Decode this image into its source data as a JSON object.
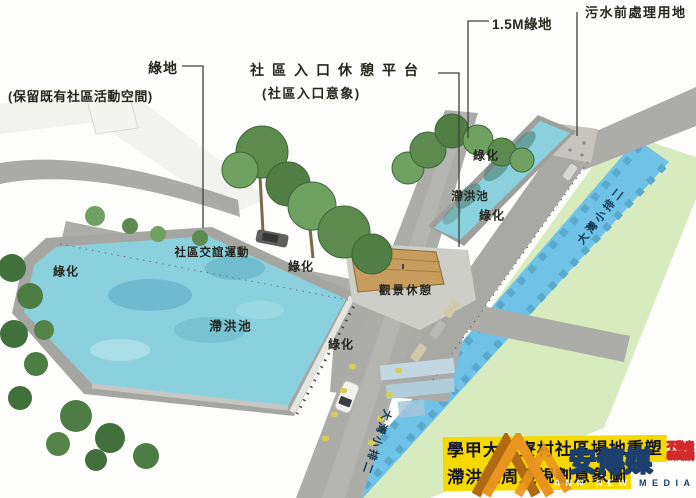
{
  "callouts": {
    "green_space": {
      "label": "綠地",
      "note": "(保留既有社區活動空間)"
    },
    "entry_platform": {
      "label": "社區入口休憩平台",
      "note": "(社區入口意象)"
    },
    "green_strip": {
      "label": "1.5M綠地"
    },
    "sewage_site": {
      "label": "污水前處理用地"
    }
  },
  "scene_labels": {
    "greening": "綠化",
    "detention_pond": "滯洪池",
    "community_social": "社區交誼運動",
    "scenic_rest": "觀景休憩",
    "drain_canal": "大灣小排二"
  },
  "banner": {
    "line1": "學甲大灣寮村社區場地重塑",
    "line2": "滯洪池周邊規劃意象圖",
    "bg_color": "#f6d900",
    "text_color": "#12122c"
  },
  "watermark": {
    "name": "安傳媒",
    "tagline_line1": "不動產",
    "tagline_line2": "新聞網",
    "media_label": "MEDIA",
    "ghost_text": "ANN NEWS W",
    "logo_color": "#e8941e",
    "navy_color": "#1c3f6e",
    "red_color": "#d22a2a"
  },
  "scene_colors": {
    "water": "#8bd0dd",
    "canal": "#70c3e6",
    "road": "#acaca8",
    "field_green": "#d7ebbf",
    "tree_green": "#5d8b4f",
    "deck_wood": "#c79c5c"
  }
}
